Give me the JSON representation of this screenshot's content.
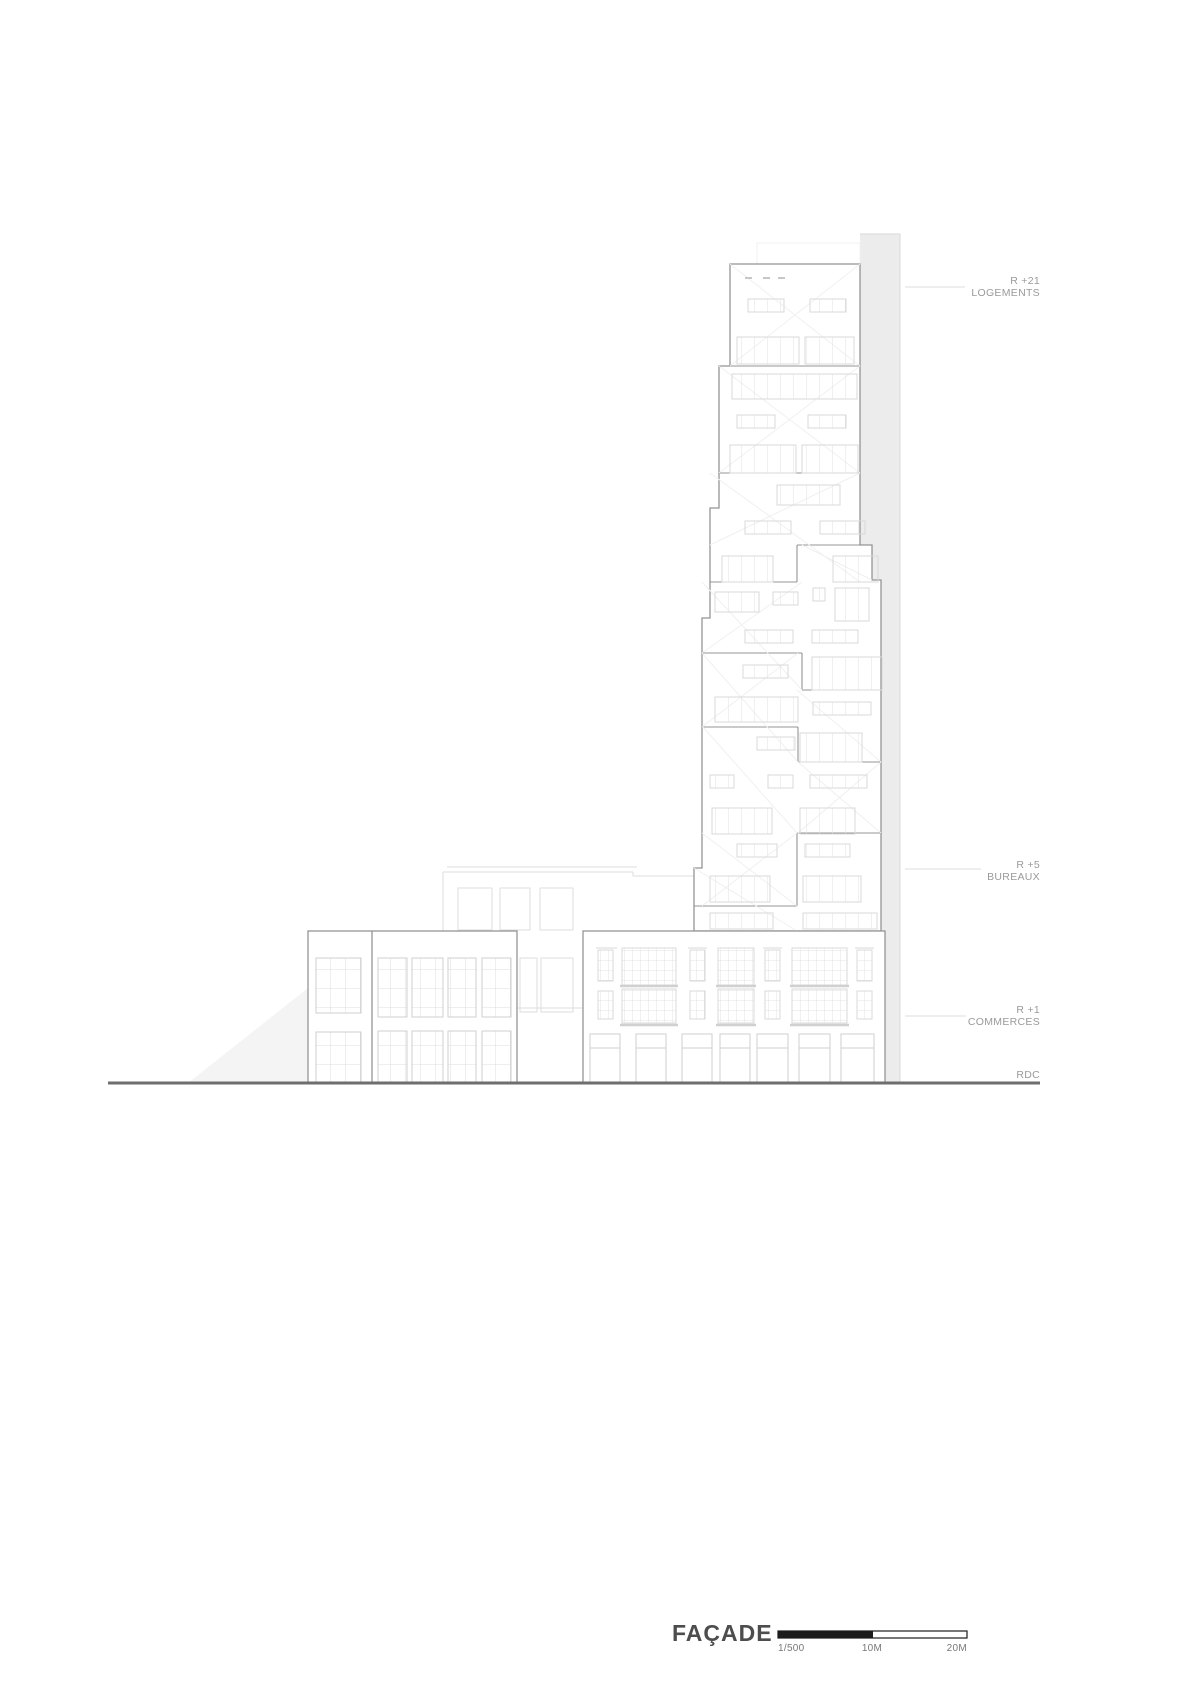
{
  "drawing": {
    "title": "FAÇADE",
    "annotations": {
      "r21": {
        "level": "R +21",
        "use": "LOGEMENTS"
      },
      "r5": {
        "level": "R +5",
        "use": "BUREAUX"
      },
      "r1": {
        "level": "R +1",
        "use": "COMMERCES"
      },
      "rdc": {
        "level": "RDC"
      }
    },
    "scale_bar": {
      "ratio": "1/500",
      "mid": "10M",
      "end": "20M"
    },
    "colors": {
      "outline": "#949494",
      "window": "#d9d9d9",
      "faint": "#f0f0f0",
      "band": "#ececec",
      "ground": "#6e6e6e",
      "annotation": "#9a9a9a",
      "title": "#4d4d4d",
      "scalebar": "#1c1c1c"
    }
  }
}
